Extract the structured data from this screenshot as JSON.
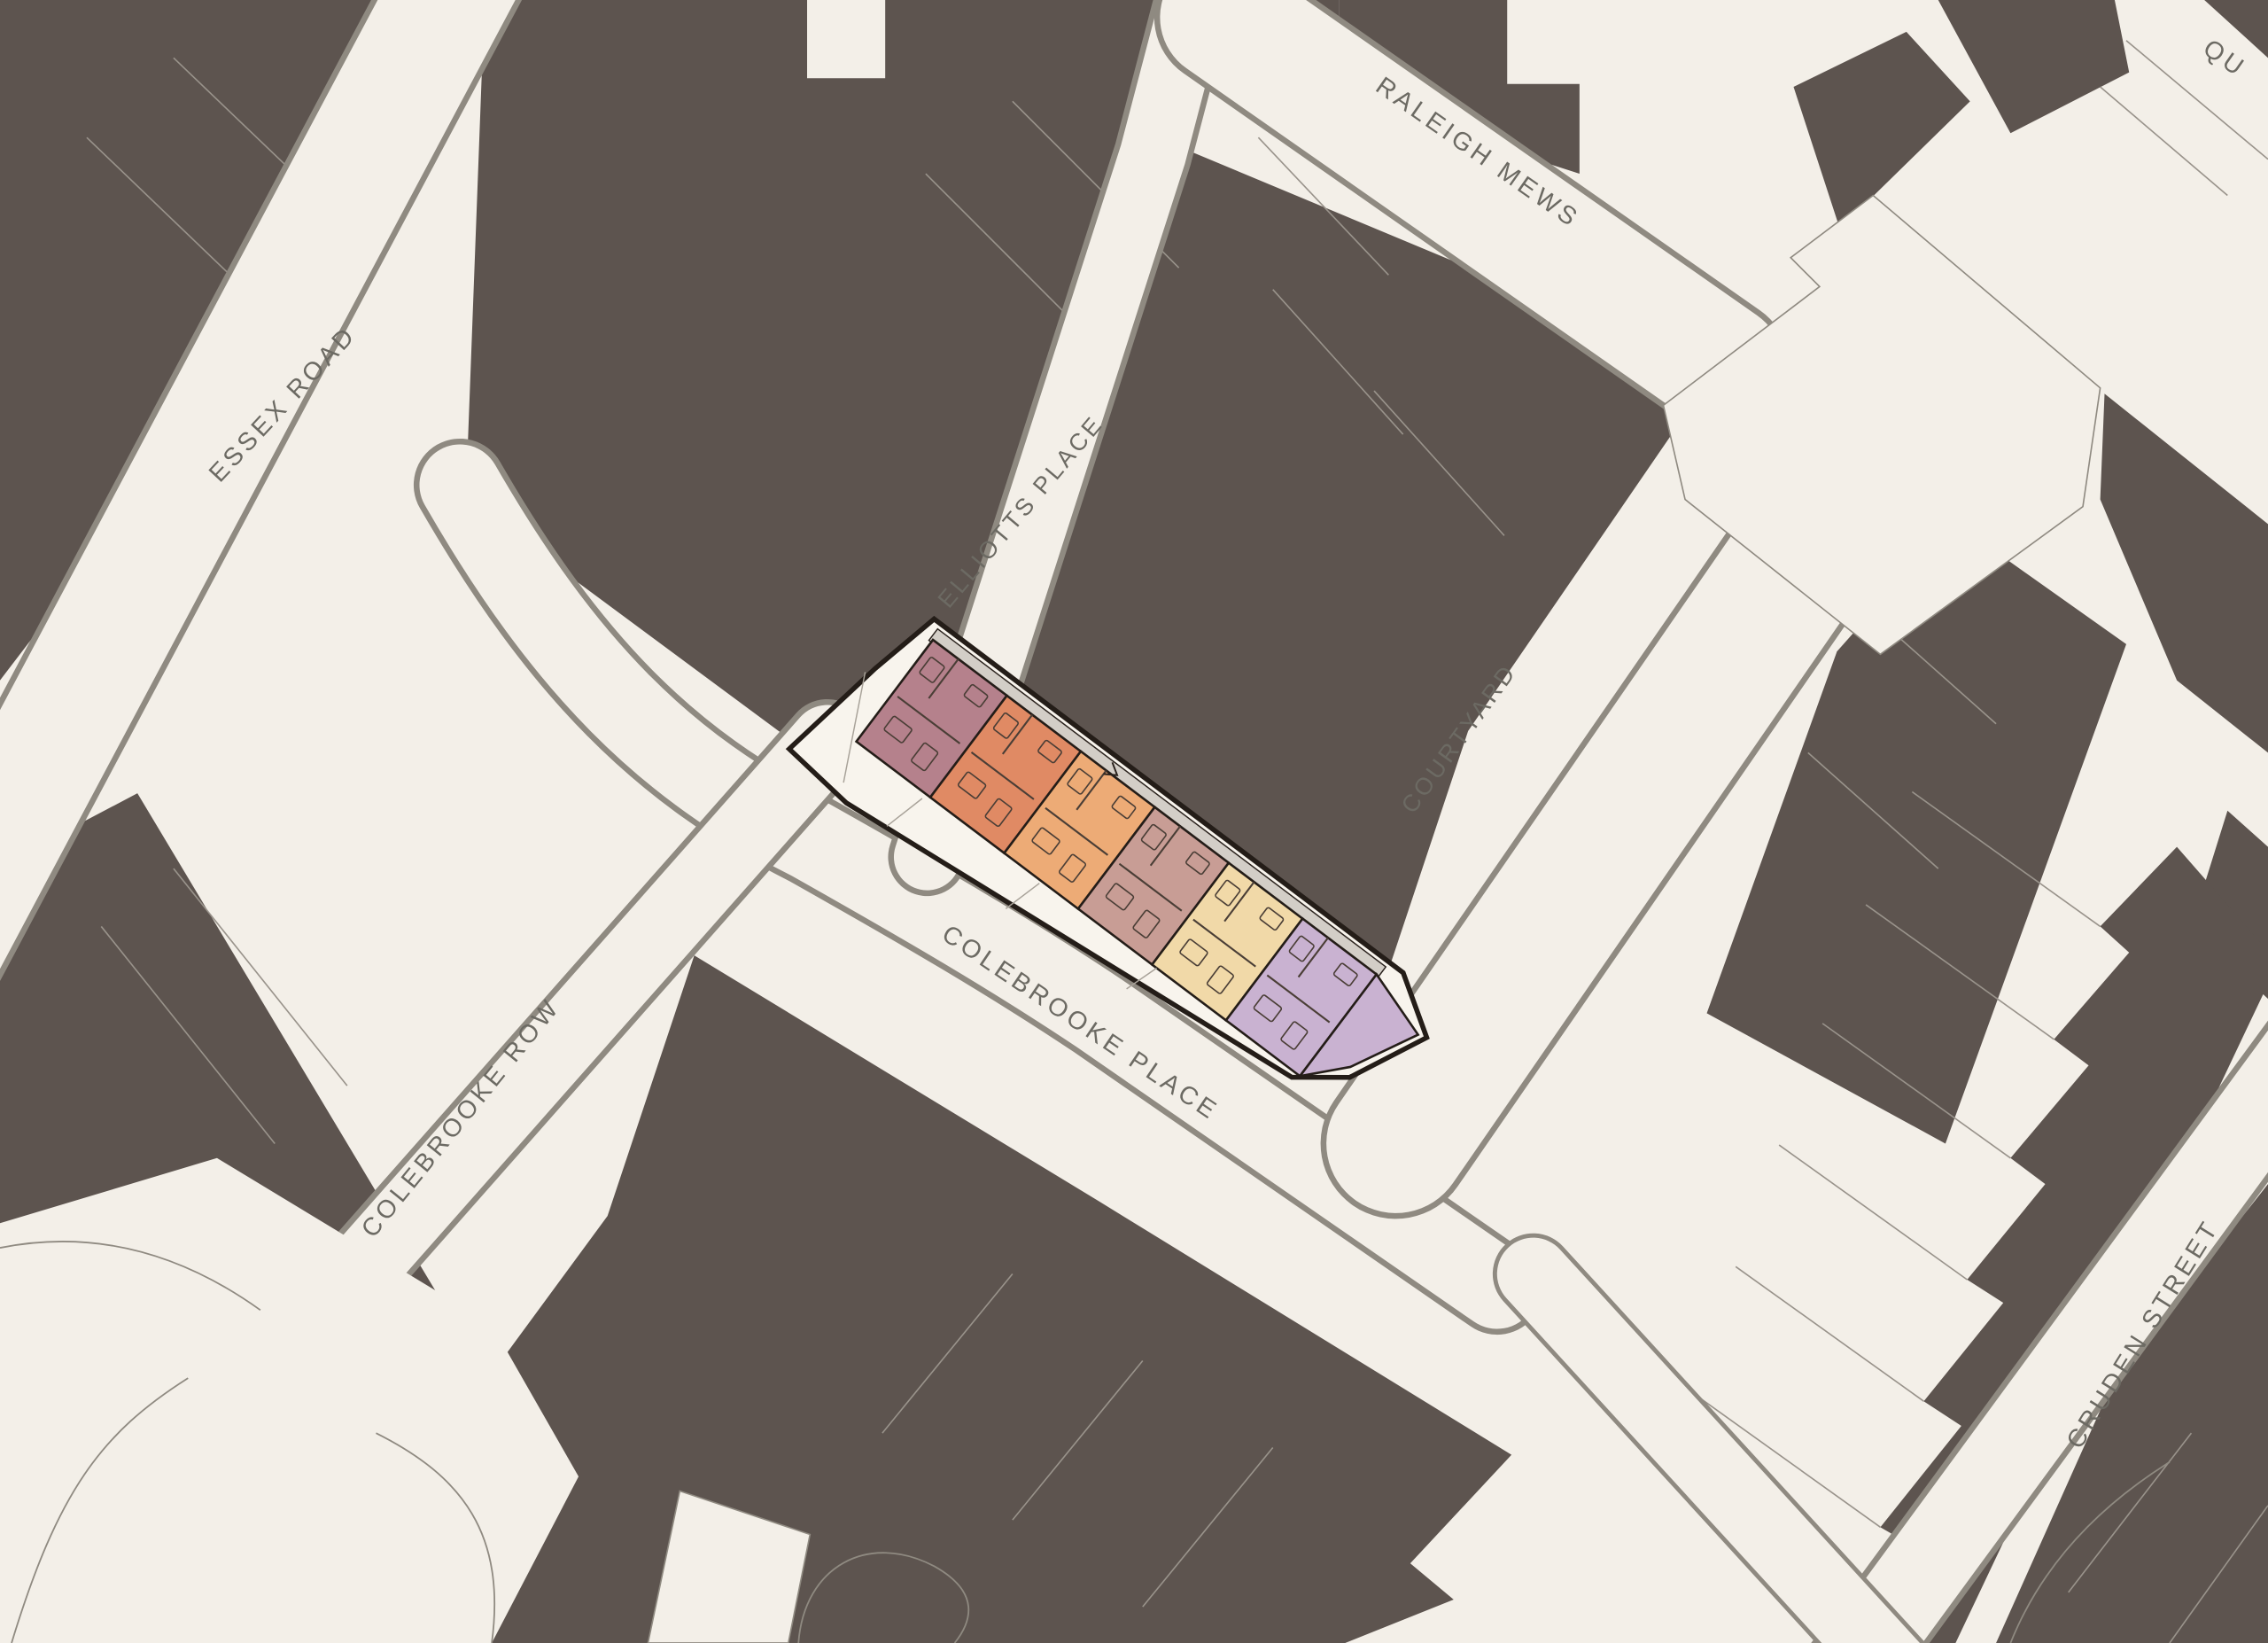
{
  "title": "Colebrooke Place site location plan",
  "map": {
    "colors": {
      "background": "#f3efe8",
      "building": "#5d544f",
      "plot_line": "#99938b",
      "road_edge": "#8f8a81",
      "label_text": "#6c6a63"
    },
    "streets": [
      {
        "id": "essex-road",
        "label": "ESSEX ROAD"
      },
      {
        "id": "elliotts-place",
        "label": "ELLIOTTS PLACE"
      },
      {
        "id": "raleigh-mews",
        "label": "RALEIGH MEWS"
      },
      {
        "id": "courtyard",
        "label": "COURTYARD"
      },
      {
        "id": "colebrooke-row",
        "label": "COLEBROOKE ROW"
      },
      {
        "id": "colebrooke-place",
        "label": "COLEBROOKE PLACE"
      },
      {
        "id": "cruden-street",
        "label": "CRUDEN STREET"
      },
      {
        "id": "street-partial-top-right",
        "label": "QU",
        "partial": true
      }
    ]
  },
  "site": {
    "name": "highlighted development site",
    "outline_color": "#241d18",
    "fill": "#f8f4ed",
    "walkway_color": "#d3cec7",
    "room_line_color": "#4a3e36",
    "units": [
      {
        "id": "unit-1",
        "color": "#b5818c"
      },
      {
        "id": "unit-2",
        "color": "#e08a64"
      },
      {
        "id": "unit-3",
        "color": "#edab76"
      },
      {
        "id": "unit-4",
        "color": "#c89d95"
      },
      {
        "id": "unit-5",
        "color": "#f1d9a8"
      },
      {
        "id": "unit-6",
        "color": "#c9b2d1"
      }
    ]
  }
}
